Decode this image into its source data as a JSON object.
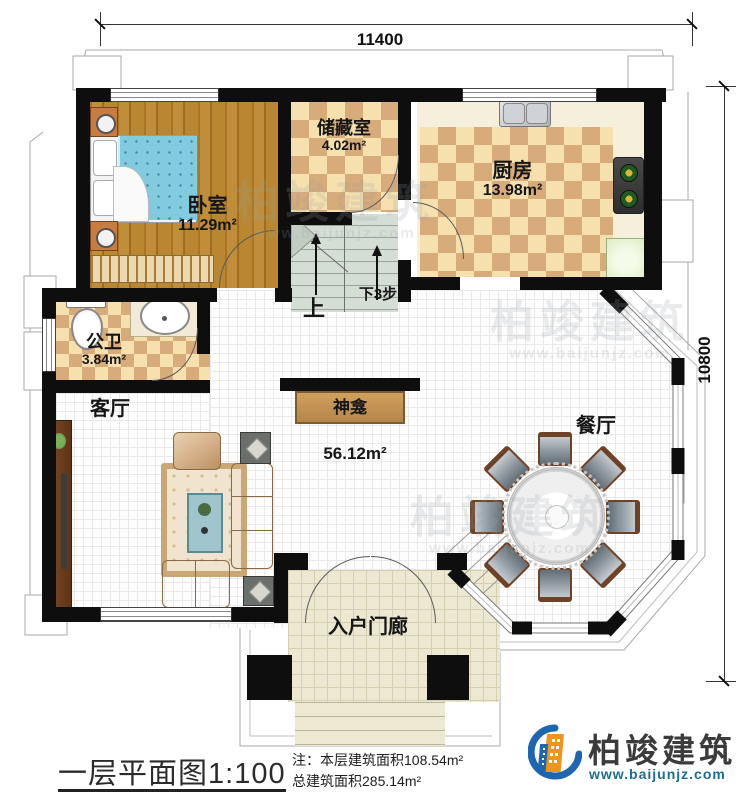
{
  "dimensions": {
    "top": "11400",
    "right": "10800"
  },
  "rooms": {
    "bedroom": {
      "label": "卧室",
      "area": "11.29m²"
    },
    "storage": {
      "label": "储藏室",
      "area": "4.02m²"
    },
    "kitchen": {
      "label": "厨房",
      "area": "13.98m²"
    },
    "bathroom": {
      "label": "公卫",
      "area": "3.84m²"
    },
    "living": {
      "label": "客厅"
    },
    "dining": {
      "label": "餐厅"
    },
    "porch": {
      "label": "入户门廊"
    },
    "shrine": {
      "label": "神龛"
    },
    "hall": {
      "area": "56.12m²"
    }
  },
  "stairs": {
    "up": "上",
    "down": "下3步"
  },
  "title_block": {
    "title": "一层平面图",
    "scale": "1:100",
    "note_line1": "注：本层建筑面积108.54m²",
    "note_line2": "总建筑面积285.14m²"
  },
  "branding": {
    "company": "柏竣建筑",
    "website": "www.baijunjz.com",
    "accent_orange": "#f0941e",
    "accent_blue": "#1e66b0",
    "website_color": "#1d6e8e"
  }
}
